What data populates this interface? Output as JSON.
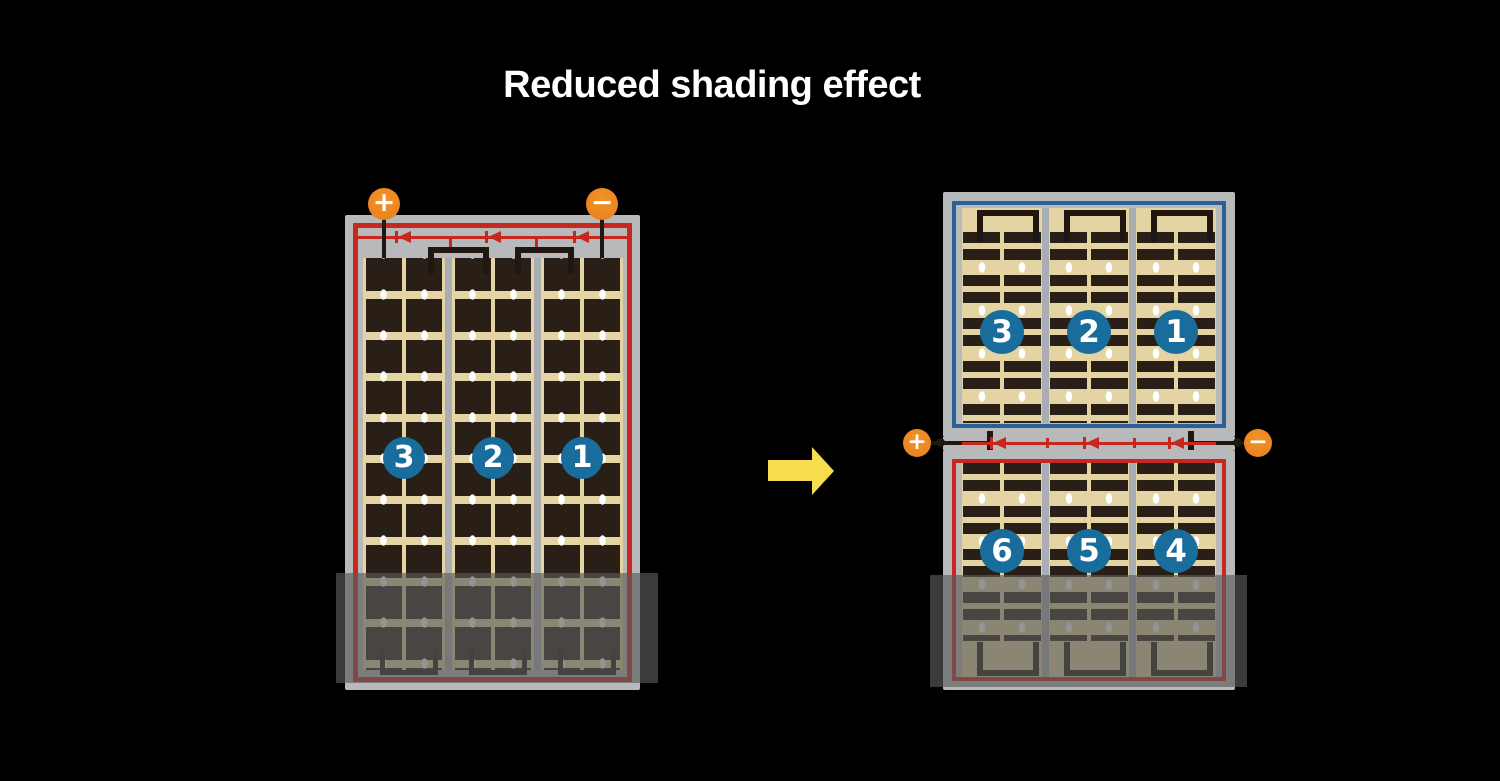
{
  "title": "Reduced shading effect",
  "colors": {
    "background": "#000000",
    "panel_frame": "#B8B9BB",
    "divider": "#A9AEB4",
    "cell_field": "#E4D3A3",
    "cell": "#2A1F17",
    "series_red": "#C6281E",
    "half_cut_blue": "#2B6094",
    "number_circle": "#196D9D",
    "terminal": "#EA8420",
    "arrow": "#F6DD4D"
  },
  "conventional_module": {
    "terminal_plus": "+",
    "terminal_minus": "−",
    "cell_strings": [
      "3",
      "2",
      "1"
    ]
  },
  "half_cut_module": {
    "terminal_plus": "+",
    "terminal_minus": "−",
    "upper_cell_strings": [
      "3",
      "2",
      "1"
    ],
    "lower_cell_strings": [
      "6",
      "5",
      "4"
    ]
  }
}
